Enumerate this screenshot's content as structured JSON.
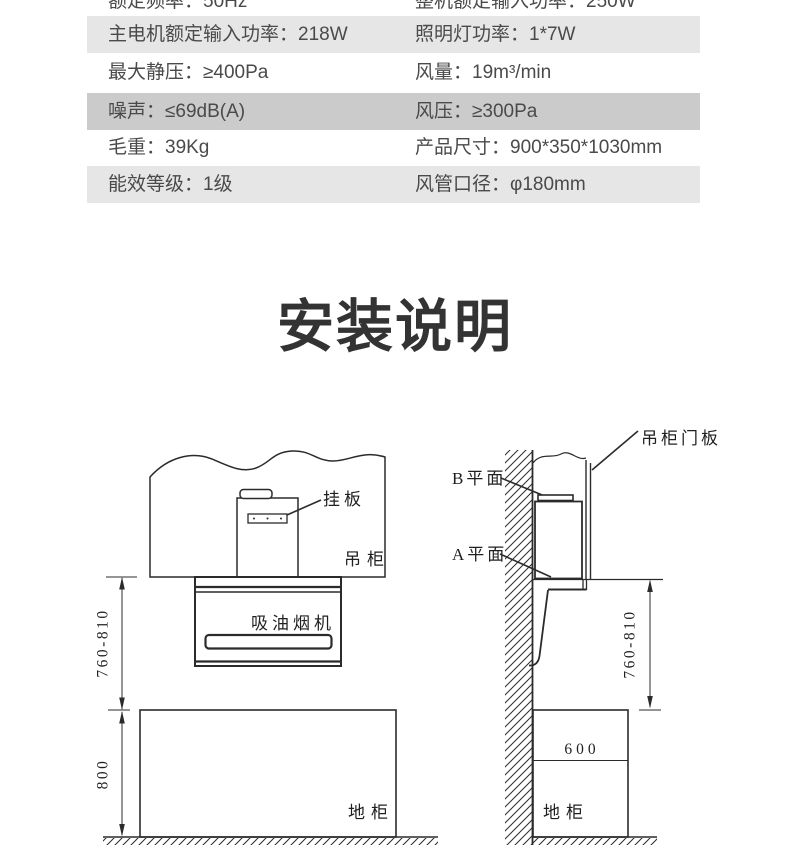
{
  "colors": {
    "row_light": "#e6e6e6",
    "row_dark": "#cbcbcb",
    "table_text": "#4a4a4a",
    "heading_text": "#333333",
    "diagram_line": "#2b2b2b"
  },
  "spec_table": {
    "rows": [
      {
        "left": "额定频率：50Hz",
        "right": "整机额定输入功率：250W"
      },
      {
        "left": "主电机额定输入功率：218W",
        "right": "照明灯功率：1*7W"
      },
      {
        "left": "最大静压：≥400Pa",
        "right": "风量：19m³/min"
      },
      {
        "left": "噪声：≤69dB(A)",
        "right": "风压：≥300Pa"
      },
      {
        "left": "毛重：39Kg",
        "right": "产品尺寸：900*350*1030mm"
      },
      {
        "left": "能效等级：1级",
        "right": "风管口径：φ180mm"
      }
    ]
  },
  "heading": {
    "title": "安装说明"
  },
  "diagrams": {
    "front": {
      "hanging_plate_label": "挂板",
      "wall_cabinet_label": "吊柜",
      "range_hood_label": "吸油烟机",
      "floor_cabinet_label": "地柜",
      "hood_height_dim": "760-810",
      "counter_height_dim": "800"
    },
    "side": {
      "door_panel_label": "吊柜门板",
      "plane_b_label": "B平面",
      "plane_a_label": "A平面",
      "hood_height_dim": "760-810",
      "counter_depth_dim": "600",
      "floor_cabinet_label": "地柜"
    }
  }
}
